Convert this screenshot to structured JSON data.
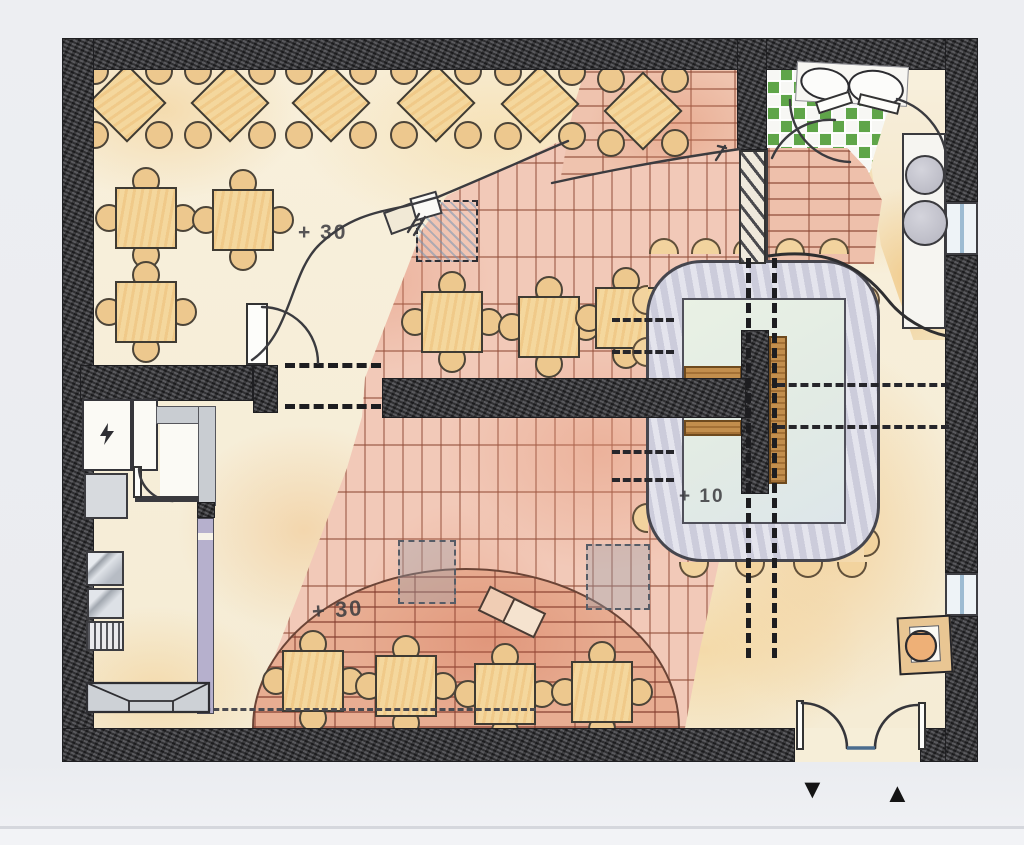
{
  "plan": {
    "labels": {
      "terrace_level": "+ 30",
      "stage_level": "+ 30",
      "bar_level": "+ 10"
    },
    "markers": {
      "exit_triangle": "▼",
      "entry_triangle": "▲"
    },
    "icons": {
      "electrical": "lightning-icon",
      "exit_marker": "triangle-down-icon",
      "entry_marker": "triangle-up-icon"
    },
    "colors": {
      "wall": "#3e3e42",
      "floor_cream": "#f7efd9",
      "floor_warm_wash": "#f0d19e",
      "brick_field": "#f2c9b8",
      "brick_joint": "#b96a52",
      "stage_brick": "#e8ad92",
      "bar_counter": "#d9d9e5",
      "bar_inner": "#e9f1e4",
      "wood": "#c28e4d",
      "tile_green": "#5fa549",
      "partition_purple": "#b6b0cd",
      "counter_gray": "#ccd0d5",
      "window_blue": "#9dbbd2"
    },
    "furniture": {
      "counts": {
        "diamond_tables": 6,
        "square_tables": 10,
        "bar_stools": 17
      },
      "tables": [
        {
          "kind": "diamond",
          "cx": 127,
          "cy": 103
        },
        {
          "kind": "diamond",
          "cx": 230,
          "cy": 103
        },
        {
          "kind": "diamond",
          "cx": 331,
          "cy": 103
        },
        {
          "kind": "diamond",
          "cx": 436,
          "cy": 103
        },
        {
          "kind": "diamond",
          "cx": 540,
          "cy": 104
        },
        {
          "kind": "diamond",
          "cx": 643,
          "cy": 111
        },
        {
          "kind": "square",
          "cx": 146,
          "cy": 218
        },
        {
          "kind": "square",
          "cx": 243,
          "cy": 220
        },
        {
          "kind": "square",
          "cx": 146,
          "cy": 312
        },
        {
          "kind": "square",
          "cx": 452,
          "cy": 322
        },
        {
          "kind": "square",
          "cx": 549,
          "cy": 327
        },
        {
          "kind": "square",
          "cx": 626,
          "cy": 318
        },
        {
          "kind": "square",
          "cx": 313,
          "cy": 681
        },
        {
          "kind": "square",
          "cx": 406,
          "cy": 686
        },
        {
          "kind": "square",
          "cx": 505,
          "cy": 694
        },
        {
          "kind": "square",
          "cx": 602,
          "cy": 692
        }
      ],
      "stools": [
        {
          "x": 664,
          "y": 246,
          "dir": "up"
        },
        {
          "x": 706,
          "y": 246,
          "dir": "up"
        },
        {
          "x": 748,
          "y": 246,
          "dir": "up"
        },
        {
          "x": 790,
          "y": 246,
          "dir": "up"
        },
        {
          "x": 834,
          "y": 246,
          "dir": "up"
        },
        {
          "x": 872,
          "y": 300,
          "dir": "right"
        },
        {
          "x": 872,
          "y": 352,
          "dir": "right"
        },
        {
          "x": 872,
          "y": 438,
          "dir": "right"
        },
        {
          "x": 872,
          "y": 496,
          "dir": "right"
        },
        {
          "x": 872,
          "y": 542,
          "dir": "right"
        },
        {
          "x": 694,
          "y": 570,
          "dir": "down"
        },
        {
          "x": 750,
          "y": 570,
          "dir": "down"
        },
        {
          "x": 808,
          "y": 570,
          "dir": "down"
        },
        {
          "x": 852,
          "y": 570,
          "dir": "down"
        },
        {
          "x": 640,
          "y": 300,
          "dir": "left"
        },
        {
          "x": 640,
          "y": 352,
          "dir": "left"
        },
        {
          "x": 640,
          "y": 518,
          "dir": "left"
        }
      ]
    }
  }
}
